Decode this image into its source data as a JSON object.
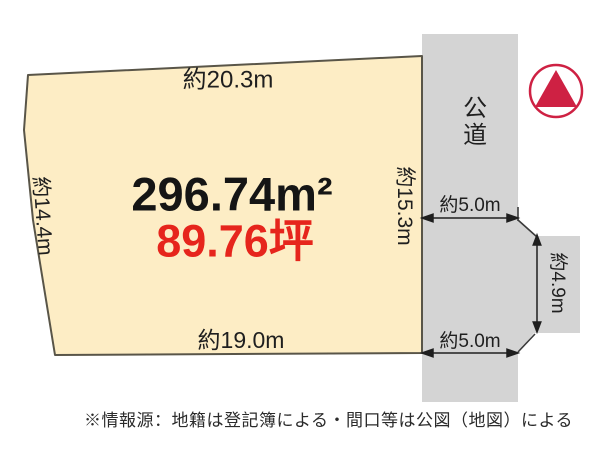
{
  "diagram": {
    "plot": {
      "area_sqm": "296.74m²",
      "area_tsubo": "89.76坪",
      "dim_top": "約20.3m",
      "dim_left": "約14.4m",
      "dim_right": "約15.3m",
      "dim_bottom": "約19.0m"
    },
    "road": {
      "label": "公道",
      "width_upper": "約5.0m",
      "width_lower": "約5.0m",
      "side_width": "約4.9m"
    },
    "colors": {
      "plot_fill": "#fdedc5",
      "road_fill": "#d4d4d4",
      "plot_border": "#595548",
      "ink": "#1f1f1f",
      "text_red": "#e6251c",
      "compass_red": "#ce2143"
    }
  },
  "footer": {
    "disclaimer": "※情報源：地籍は登記簿による・間口等は公図（地図）による"
  }
}
